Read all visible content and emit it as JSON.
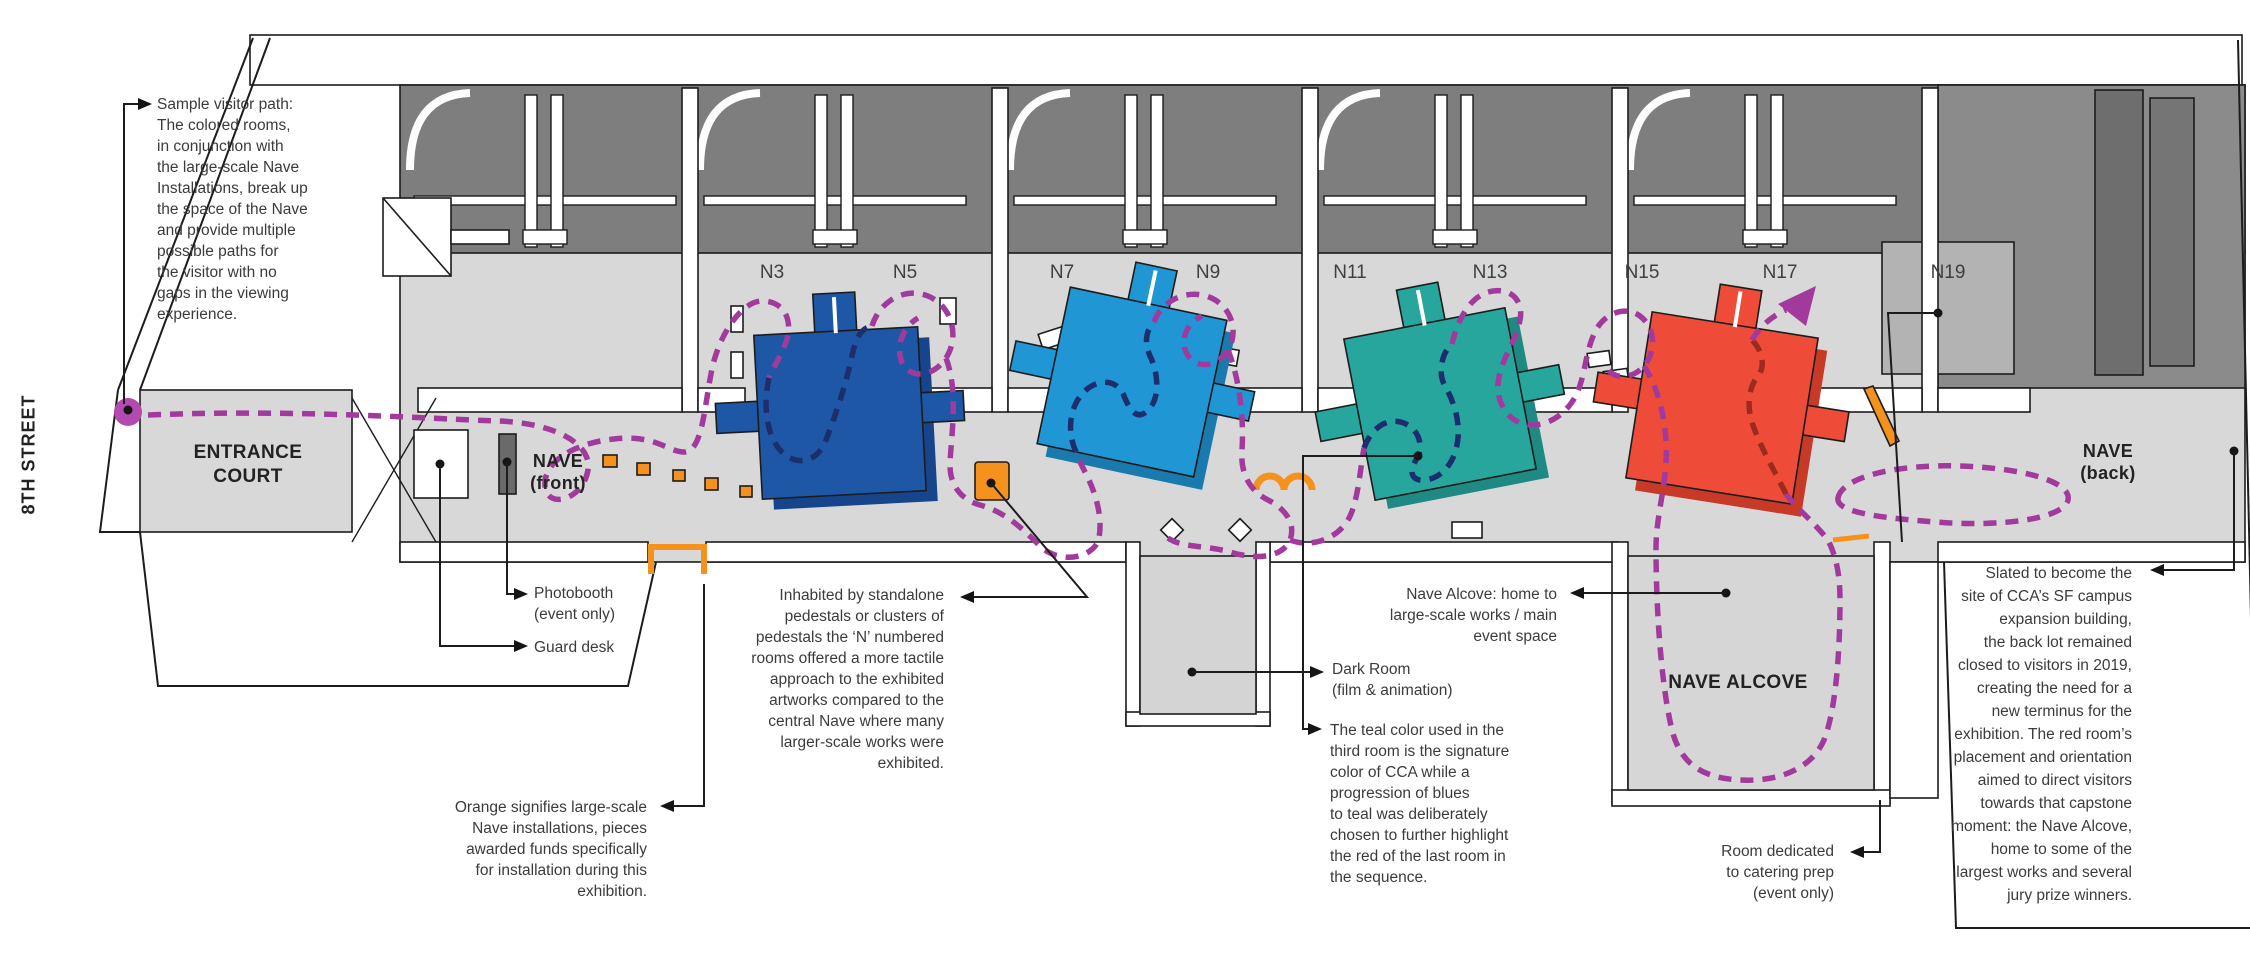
{
  "street_label": "8TH STREET",
  "areas": {
    "entrance_court": [
      "ENTRANCE",
      "COURT"
    ],
    "nave_front": [
      "NAVE",
      "(front)"
    ],
    "nave_back": [
      "NAVE",
      "(back)"
    ],
    "nave_alcove": "NAVE ALCOVE"
  },
  "rooms": [
    "N3",
    "N5",
    "N7",
    "N9",
    "N11",
    "N13",
    "N15",
    "N17",
    "N19"
  ],
  "annotations": {
    "sample_visitor_path": {
      "lines": [
        "Sample visitor path:",
        "The colored rooms,",
        "in conjunction with",
        "the large-scale Nave",
        "Installations, break up",
        "the space of the Nave",
        "and provide multiple",
        "possible paths for",
        "the visitor with no",
        "gaps in the viewing",
        "experience."
      ]
    },
    "photobooth": {
      "lines": [
        "Photobooth",
        "(event only)"
      ]
    },
    "guard_desk": {
      "lines": [
        "Guard desk"
      ]
    },
    "orange_note": {
      "lines": [
        "Orange signifies large-scale",
        "Nave installations, pieces",
        "awarded funds specifically",
        "for installation during this",
        "exhibition."
      ]
    },
    "inhabited_note": {
      "lines": [
        "Inhabited by standalone",
        "pedestals or clusters of",
        "pedestals the ‘N’ numbered",
        "rooms offered a more tactile",
        "approach to the exhibited",
        "artworks compared to the",
        "central Nave where many",
        "larger-scale works were",
        "exhibited."
      ]
    },
    "nave_alcove_note": {
      "lines": [
        "Nave Alcove: home to",
        "large-scale works / main",
        "event space"
      ]
    },
    "dark_room_note": {
      "lines": [
        "Dark Room",
        "(film & animation)"
      ]
    },
    "teal_note": {
      "lines": [
        "The teal color used in the",
        "third room is the signature",
        "color of CCA while a",
        "progression of blues",
        "to teal was deliberately",
        "chosen to further highlight",
        "the red of the last room in",
        "the sequence."
      ]
    },
    "catering_note": {
      "lines": [
        "Room dedicated",
        "to catering prep",
        "(event only)"
      ]
    },
    "slated_note": {
      "lines": [
        "Slated to become the",
        "site of CCA’s SF campus",
        "expansion building,",
        "the back lot remained",
        "closed to visitors in 2019,",
        "creating the need for a",
        "new terminus for the",
        "exhibition. The red room’s",
        "placement and orientation",
        "aimed to direct visitors",
        "towards that capstone",
        "moment: the Nave Alcove,",
        "home to some of the",
        "largest works and several",
        "jury prize winners."
      ]
    }
  },
  "colors": {
    "path": "#A23A9E",
    "path_on_blue": "#1D2E6E",
    "path_on_red": "#9C2B1E",
    "navy": "#1D57A5",
    "navy_dark": "#16458B",
    "blue": "#2196D4",
    "blue_dark": "#1A7AAE",
    "teal": "#27A69E",
    "teal_dark": "#1E8A83",
    "red": "#EE4C38",
    "red_dark": "#C73A28",
    "orange": "#F5921E",
    "magenta_dot": "#B44AB0",
    "dark_gray": "#7E7E7E",
    "mid_gray": "#8B8B8B",
    "n19_gray": "#B3B3B3",
    "light_gray": "#D8D8D8",
    "line": "#1C1C1C"
  }
}
